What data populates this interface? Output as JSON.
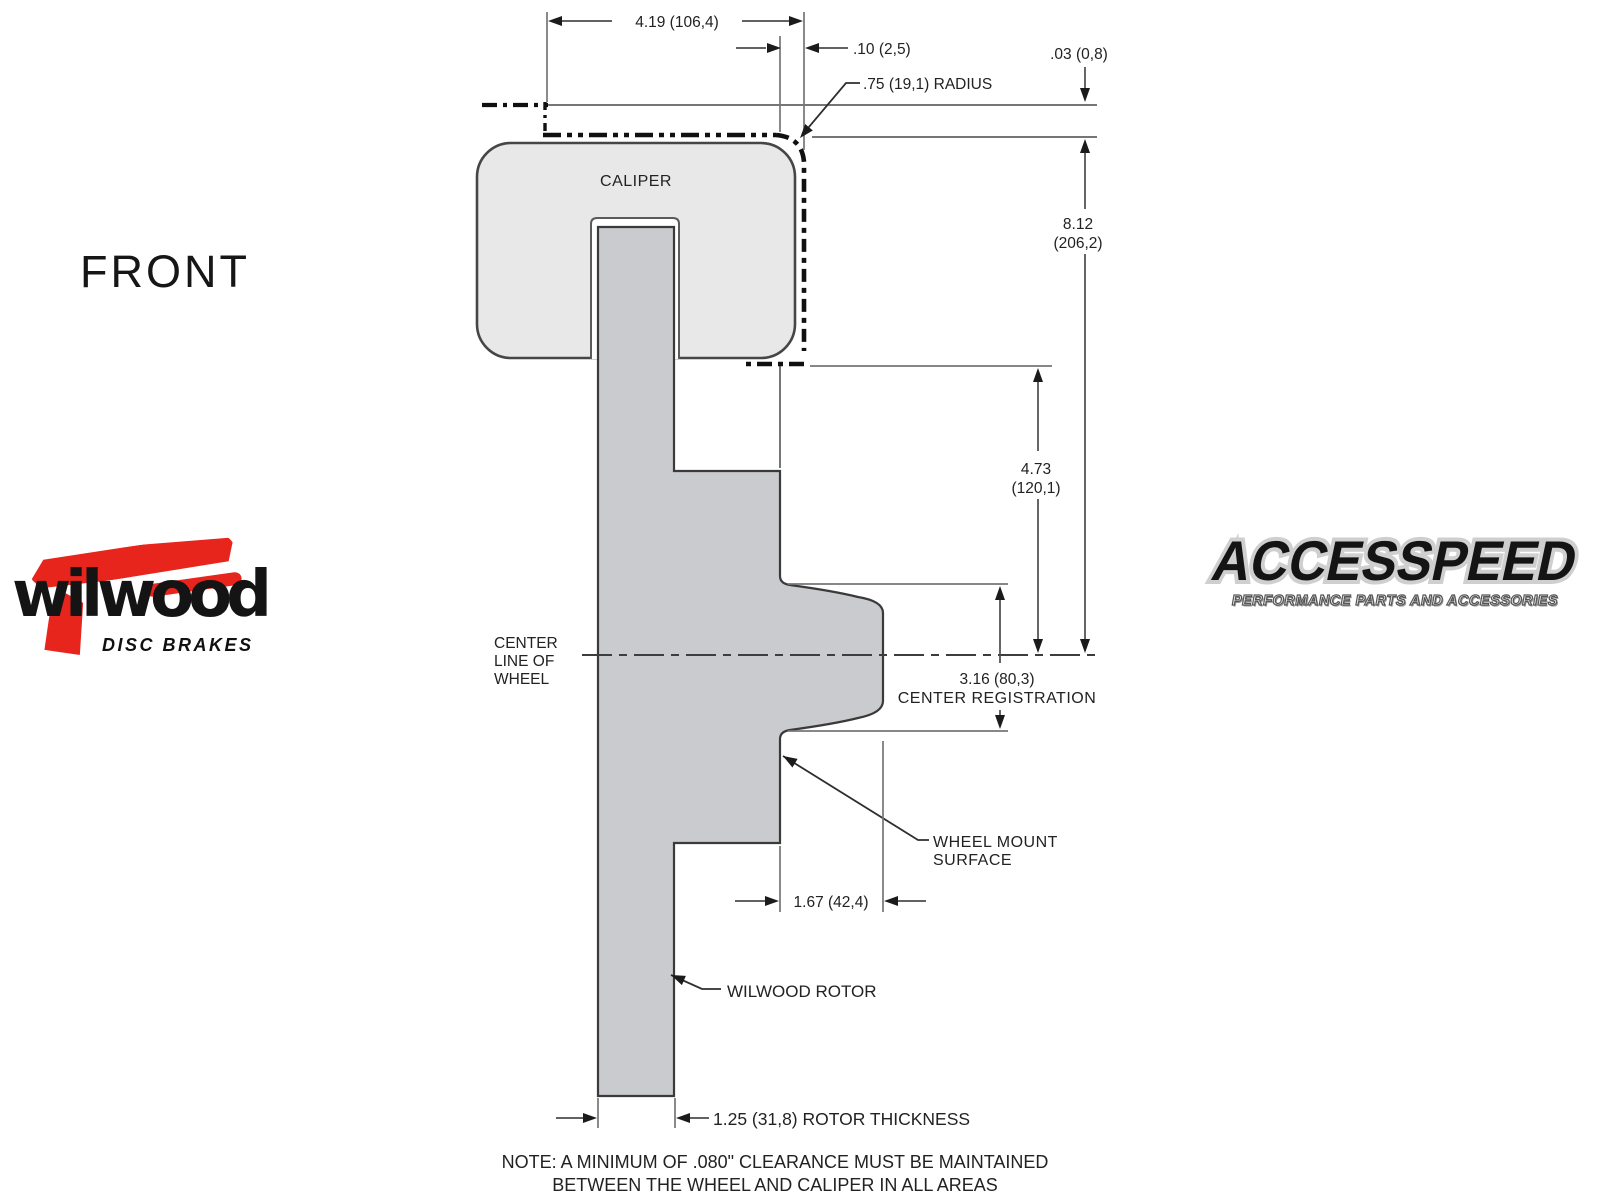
{
  "front_label": "FRONT",
  "diagram": {
    "caliper_label": "CALIPER",
    "dims": {
      "width_top": "4.19 (106,4)",
      "caliper_offset": ".10 (2,5)",
      "wheel_clearance": ".03 (0,8)",
      "radius": ".75 (19,1) RADIUS",
      "overall_height_in": "8.12",
      "overall_height_mm": "(206,2)",
      "hat_height_in": "4.73",
      "hat_height_mm": "(120,1)",
      "center_registration_value": "3.16 (80,3)",
      "center_registration_label": "CENTER REGISTRATION",
      "mount_offset": "1.67 (42,4)",
      "rotor_thickness": "1.25 (31,8) ROTOR THICKNESS"
    },
    "labels": {
      "center_line_1": "CENTER",
      "center_line_2": "LINE OF",
      "center_line_3": "WHEEL",
      "wheel_mount_1": "WHEEL MOUNT",
      "wheel_mount_2": "SURFACE",
      "rotor": "WILWOOD ROTOR"
    },
    "note_line_1": "NOTE: A MINIMUM OF .080\" CLEARANCE MUST BE MAINTAINED",
    "note_line_2": "BETWEEN THE WHEEL AND CALIPER IN ALL AREAS"
  },
  "logos": {
    "wilwood": {
      "name": "wilwood",
      "tagline": "DISC BRAKES"
    },
    "accesspeed": {
      "name": "ACCESSPEED",
      "tagline": "PERFORMANCE PARTS AND ACCESSORIES"
    }
  },
  "colors": {
    "caliper_fill": "#e8e8e8",
    "rotor_fill": "#c9cbce",
    "line_gray": "#767676",
    "ink": "#222222",
    "wilwood_red": "#e8251d"
  }
}
